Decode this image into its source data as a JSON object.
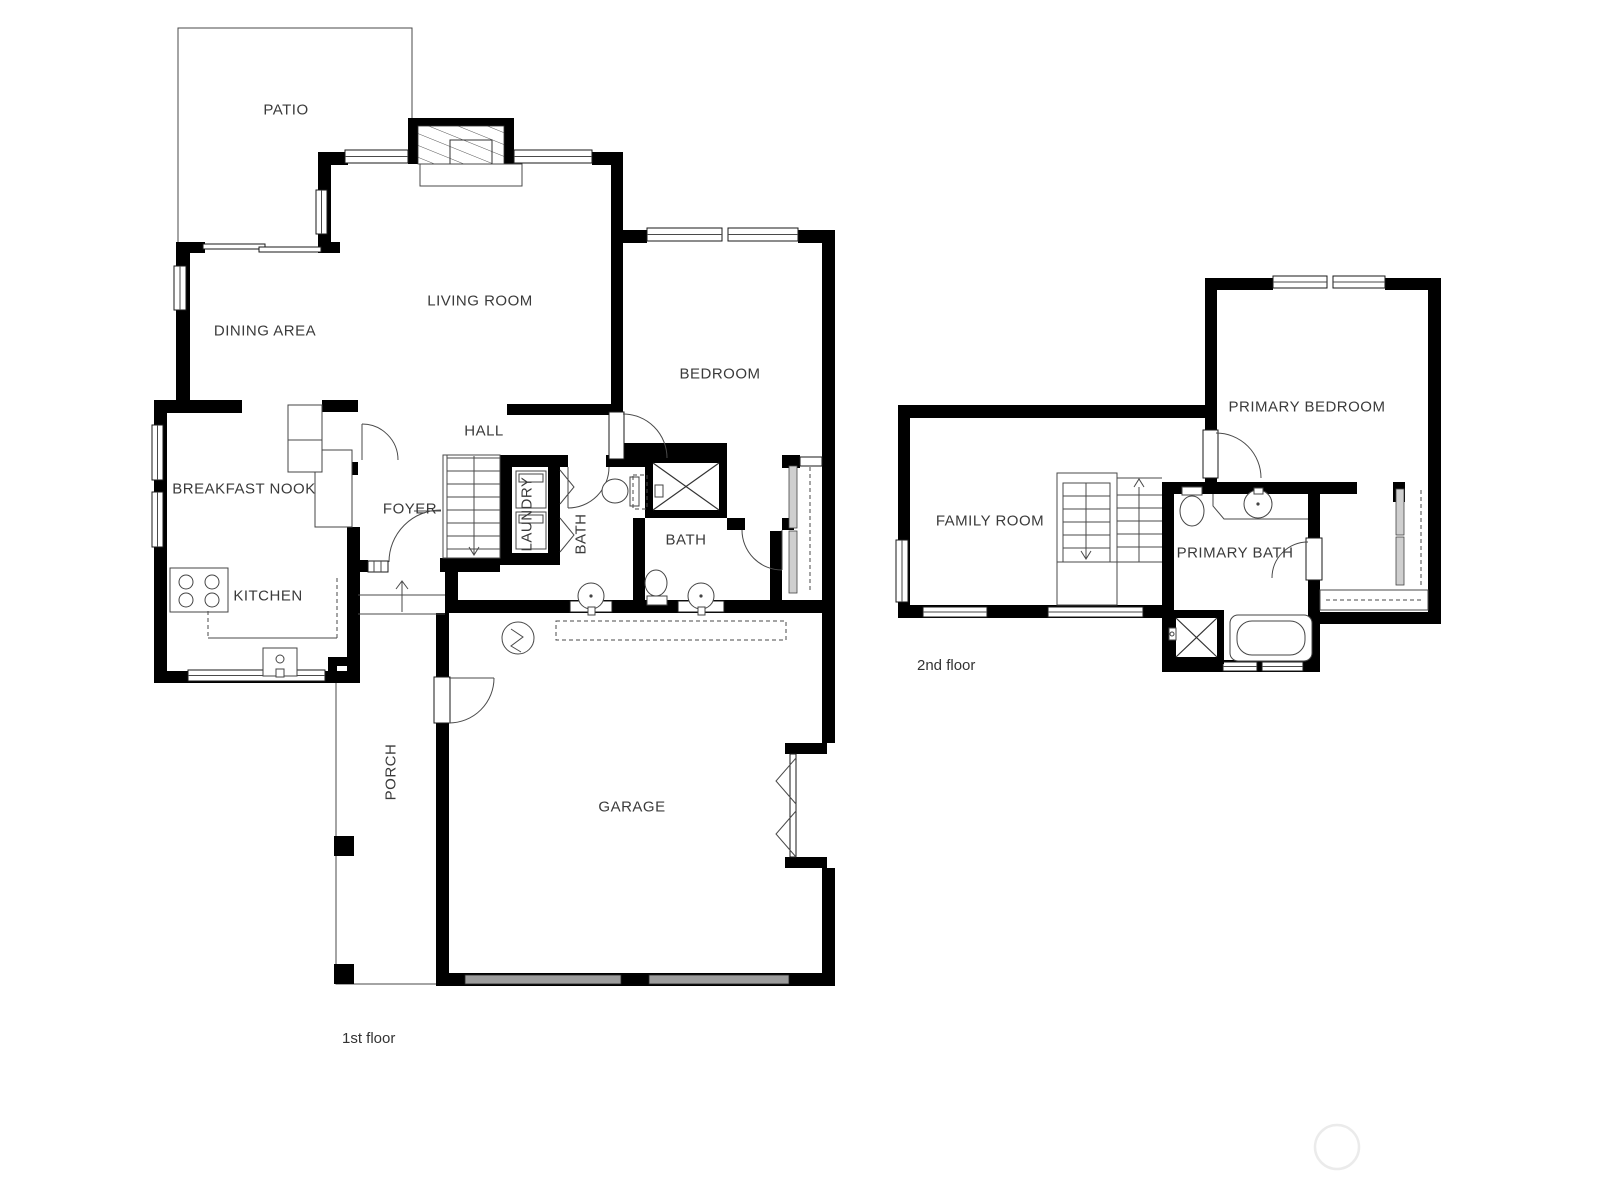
{
  "floors": {
    "first": {
      "caption": "1st floor",
      "rooms": {
        "patio": "PATIO",
        "living_room": "LIVING ROOM",
        "dining_area": "DINING AREA",
        "breakfast_nook": "BREAKFAST NOOK",
        "kitchen": "KITCHEN",
        "foyer": "FOYER",
        "hall": "HALL",
        "laundry": "LAUNDRY",
        "bath_1": "BATH",
        "bath_2": "BATH",
        "bedroom": "BEDROOM",
        "porch": "PORCH",
        "garage": "GARAGE"
      }
    },
    "second": {
      "caption": "2nd floor",
      "rooms": {
        "family_room": "FAMILY ROOM",
        "primary_bedroom": "PRIMARY BEDROOM",
        "primary_bath": "PRIMARY BATH"
      }
    }
  },
  "colors": {
    "background": "#ffffff",
    "wall": "#000000",
    "thin_line": "#4a4a4a",
    "label_text": "#3a3a3a",
    "garage_door": "#9c9c9c",
    "watermark": "#ebebeb"
  }
}
